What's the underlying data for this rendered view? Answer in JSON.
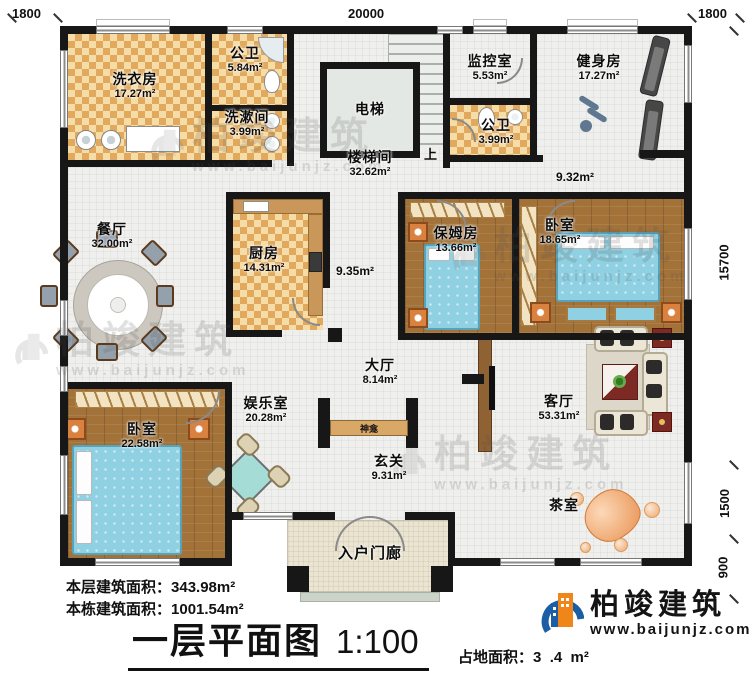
{
  "dims": {
    "top_left": "1800",
    "top_center": "20000",
    "top_right": "1800",
    "right_main": "15700",
    "right_mid": "1500",
    "right_small": "900"
  },
  "rooms": {
    "laundry": {
      "name": "洗衣房",
      "area": "17.27m²"
    },
    "bath1": {
      "name": "公卫",
      "area": "5.84m²"
    },
    "washroom": {
      "name": "洗漱间",
      "area": "3.99m²"
    },
    "elevator": {
      "name": "电梯"
    },
    "stairhall": {
      "name": "楼梯间",
      "area": "32.62m²"
    },
    "monitor": {
      "name": "监控室",
      "area": "5.53m²"
    },
    "bath2": {
      "name": "公卫",
      "area": "3.99m²"
    },
    "gym": {
      "name": "健身房",
      "area": "17.27m²"
    },
    "dining": {
      "name": "餐厅",
      "area": "32.00m²"
    },
    "kitchen": {
      "name": "厨房",
      "area": "14.31m²"
    },
    "nanny": {
      "name": "保姆房",
      "area": "13.66m²"
    },
    "bedroom_right": {
      "name": "卧室",
      "area": "18.65m²"
    },
    "hall": {
      "name": "大厅",
      "area": "8.14m²"
    },
    "recreation": {
      "name": "娱乐室",
      "area": "20.28m²"
    },
    "shrine": {
      "name": "神龛"
    },
    "foyer": {
      "name": "玄关",
      "area": "9.31m²"
    },
    "bedroom_left": {
      "name": "卧室",
      "area": "22.58m²"
    },
    "living": {
      "name": "客厅",
      "area": "53.31m²"
    },
    "tea": {
      "name": "茶室"
    },
    "porch": {
      "name": "入户门廊"
    }
  },
  "corridors": {
    "gym_side": "9.32m²",
    "mid": "9.35m²"
  },
  "stairs": {
    "up": "上"
  },
  "footer": {
    "floor_area_label": "本层建筑面积：",
    "floor_area_value": "343.98m²",
    "building_area_label": "本栋建筑面积：",
    "building_area_value": "1001.54m²",
    "title": "一层平面图",
    "scale": "1:100",
    "site_area_label": "占地面积：",
    "site_area_value": "3  .4  m²"
  },
  "brand": {
    "name": "柏竣建筑",
    "site": "www.baijunjz.com"
  },
  "watermark": {
    "name": "柏竣建筑",
    "site": "www.baijunjz.com"
  }
}
